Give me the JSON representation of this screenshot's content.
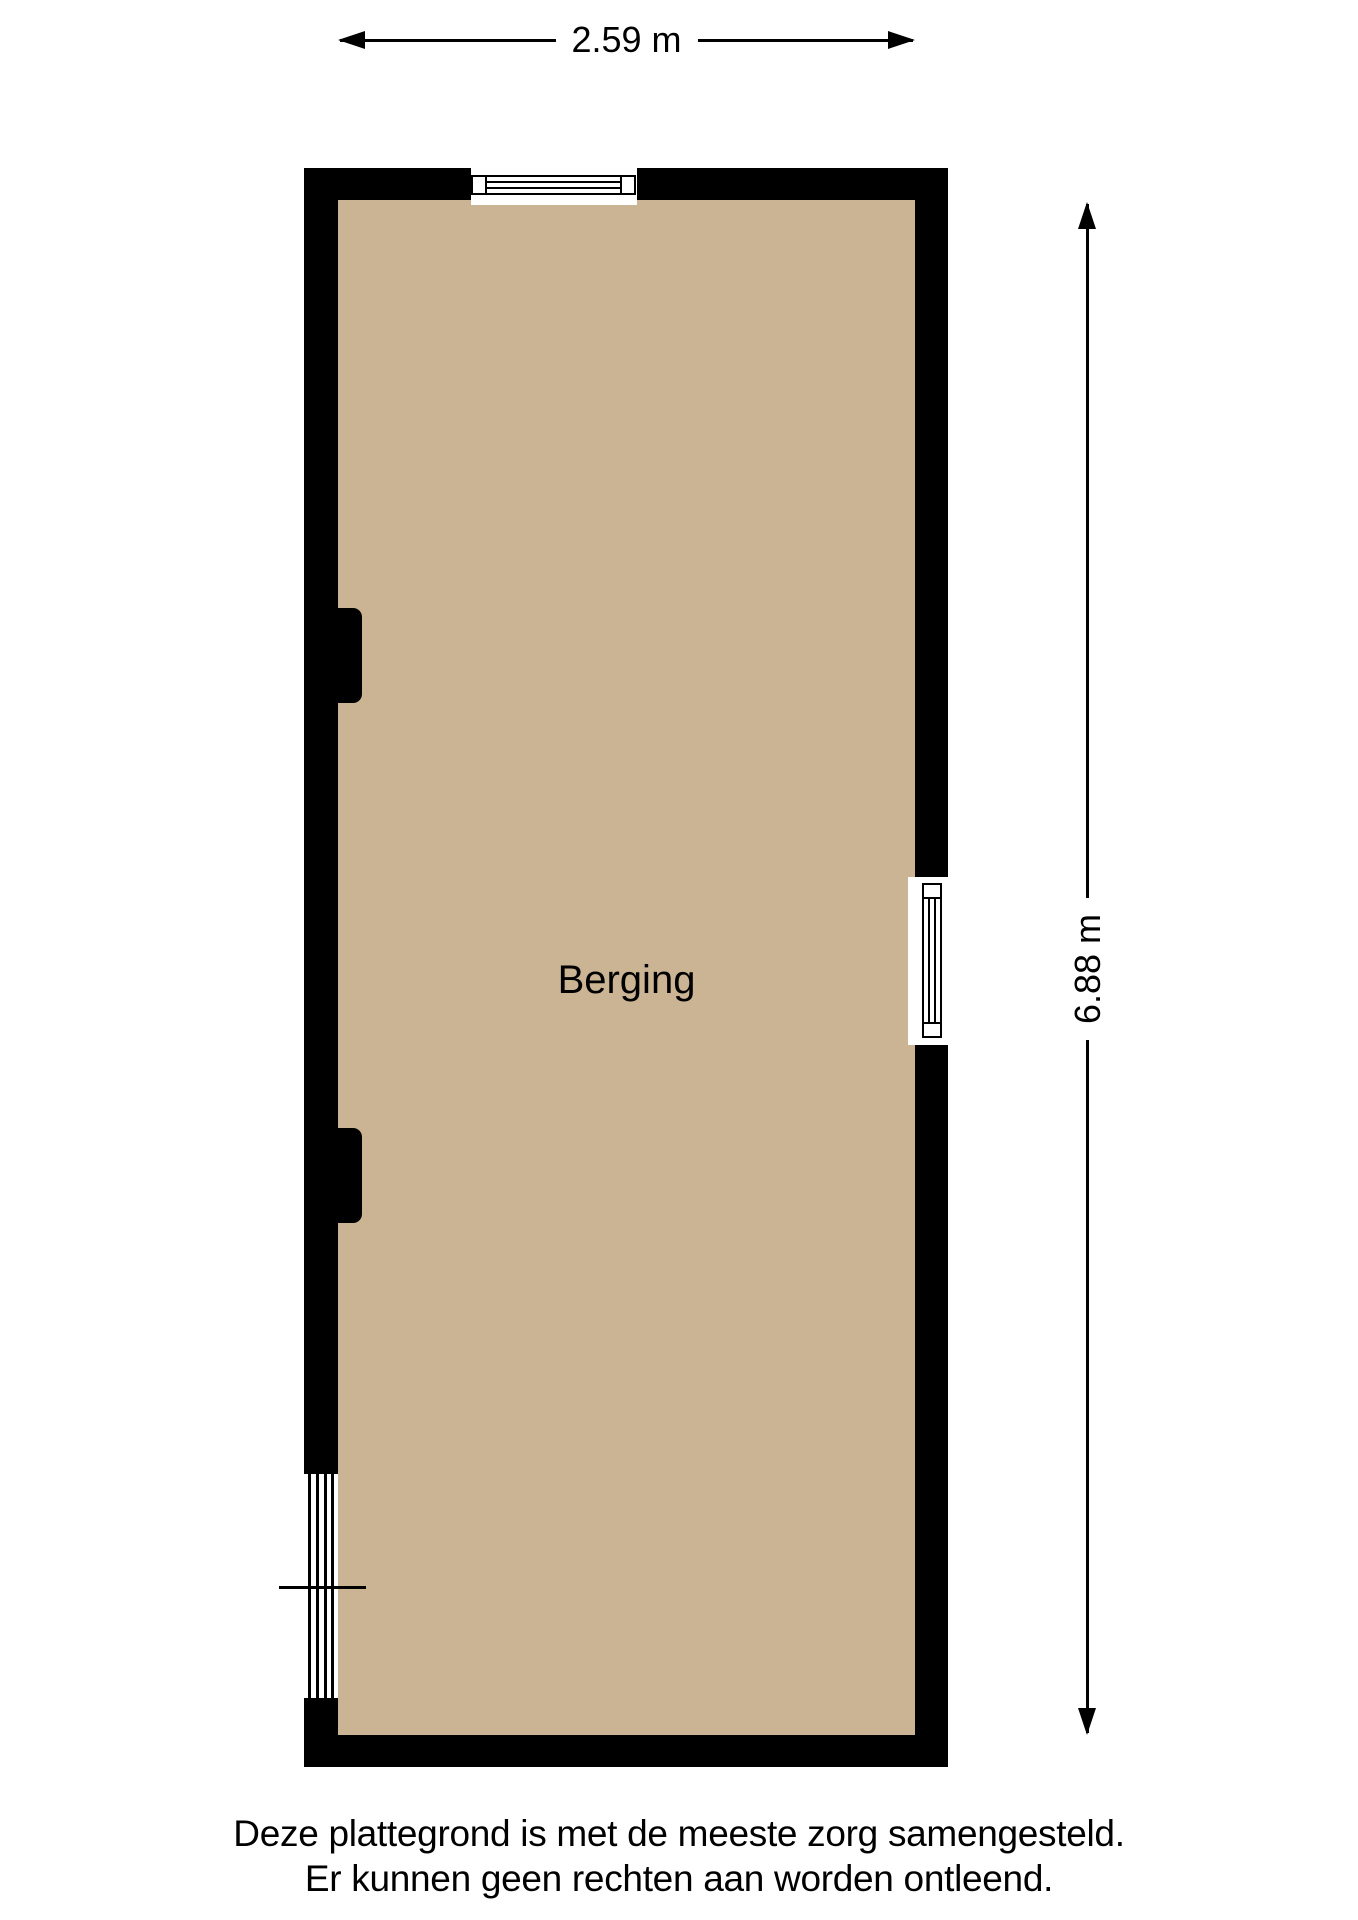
{
  "floorplan": {
    "room_label": "Berging",
    "dimensions": {
      "width_label": "2.59 m",
      "height_label": "6.88 m"
    },
    "disclaimer": {
      "line1": "Deze plattegrond is met de meeste zorg samengesteld.",
      "line2": "Er kunnen geen rechten aan worden ontleend."
    },
    "colors": {
      "floor": "#cbb494",
      "wall": "#000000",
      "background": "#ffffff",
      "dimension": "#000000",
      "ink": "#000000"
    }
  }
}
